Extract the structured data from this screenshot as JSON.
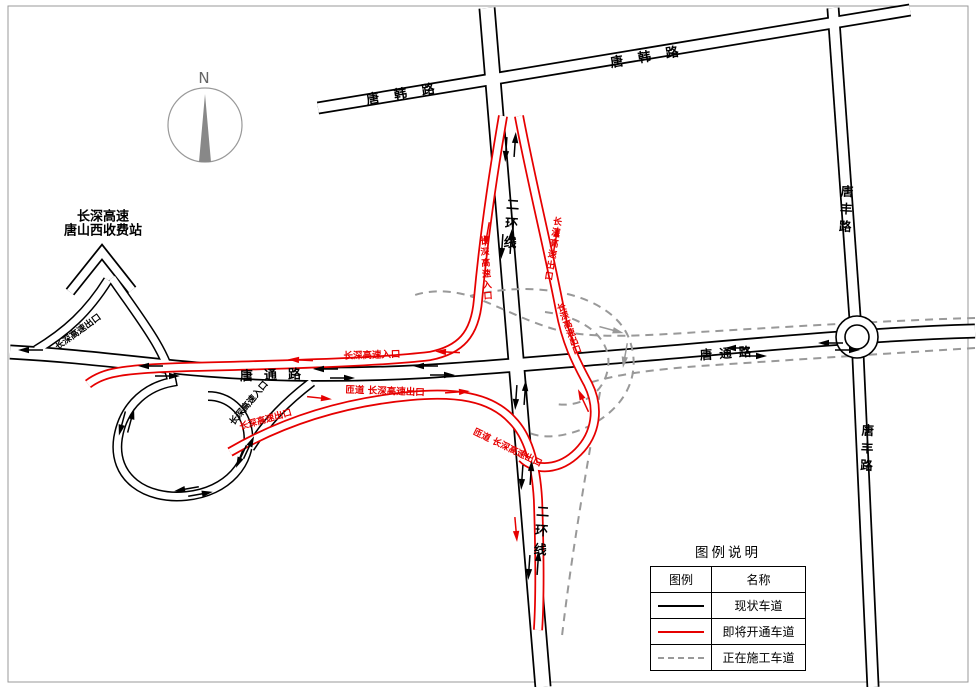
{
  "colors": {
    "existing_lane": "#000000",
    "new_lane": "#e60000",
    "construction_lane": "#999999",
    "compass": "#888888"
  },
  "compass": {
    "label": "N"
  },
  "toll_station": {
    "line1": "长深高速",
    "line2": "唐山西收费站"
  },
  "road_labels": {
    "tanghan_left": "唐韩路",
    "tanghan_right": "唐韩路",
    "erhuan_top": "二环线",
    "erhuan_bottom": "二环线",
    "tangfeng_top": "唐丰路",
    "tangfeng_bottom": "唐丰路",
    "tangtong_left": "唐通路",
    "tangtong_right": "唐通路"
  },
  "ramp_labels": {
    "entrance_vertical": "长深高速入口",
    "exit_vertical": "长深高速出口",
    "entrance_horizontal": "长深高速入口",
    "exit_horizontal": "匝道 长深高速出口",
    "exit_cross": "长深高速出口",
    "exit_south": "匝道 长深高速出口",
    "exit_toll_red": "长深高速出口",
    "exit_west_black": "长深高速出口",
    "entrance_loop_black": "长深高速入口"
  },
  "legend": {
    "title": "图例说明",
    "col_symbol": "图例",
    "col_name": "名称",
    "rows": [
      {
        "name": "现状车道",
        "style": "solid-black"
      },
      {
        "name": "即将开通车道",
        "style": "solid-red"
      },
      {
        "name": "正在施工车道",
        "style": "dashed-gray"
      }
    ]
  }
}
